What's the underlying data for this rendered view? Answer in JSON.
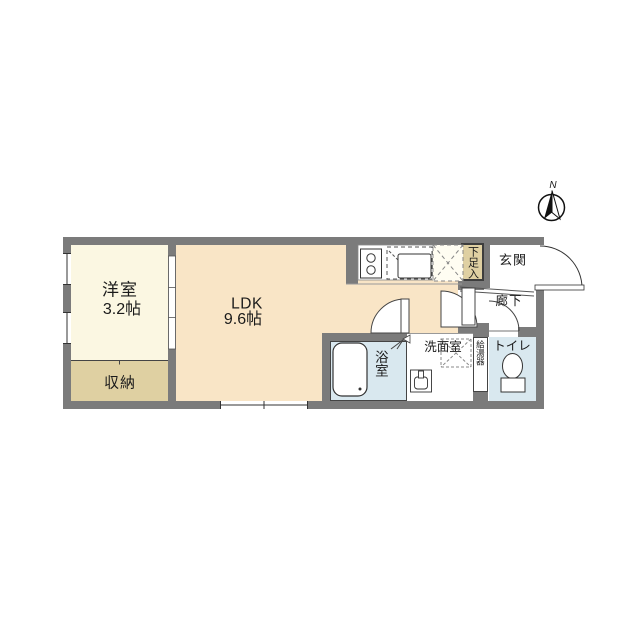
{
  "compass": {
    "north_label": "N"
  },
  "rooms": {
    "western": {
      "name": "洋室",
      "size": "3.2帖",
      "color": "#fbf7e2"
    },
    "ldk": {
      "name": "LDK",
      "size": "9.6帖",
      "color": "#f9e5c6"
    },
    "closet": {
      "label": "収納",
      "color": "#dfd0a2"
    },
    "shoe_box": {
      "label": "下足入",
      "color": "#dfd0a2"
    },
    "entrance": {
      "label": "玄関",
      "color": "#ffffff"
    },
    "hallway": {
      "label": "廊下",
      "color": "#ffffff"
    },
    "toilet": {
      "label": "トイレ",
      "color": "#d9e8ef"
    },
    "washroom": {
      "label": "洗面室",
      "color": "#ffffff"
    },
    "bathroom": {
      "label": "浴室",
      "color": "#d9e8ef"
    },
    "water_heater": {
      "label": "給湯器",
      "color": "#ffffff"
    }
  },
  "colors": {
    "wall": "#7b7b7b",
    "background": "#ffffff",
    "outline": "#3d3d3d"
  }
}
